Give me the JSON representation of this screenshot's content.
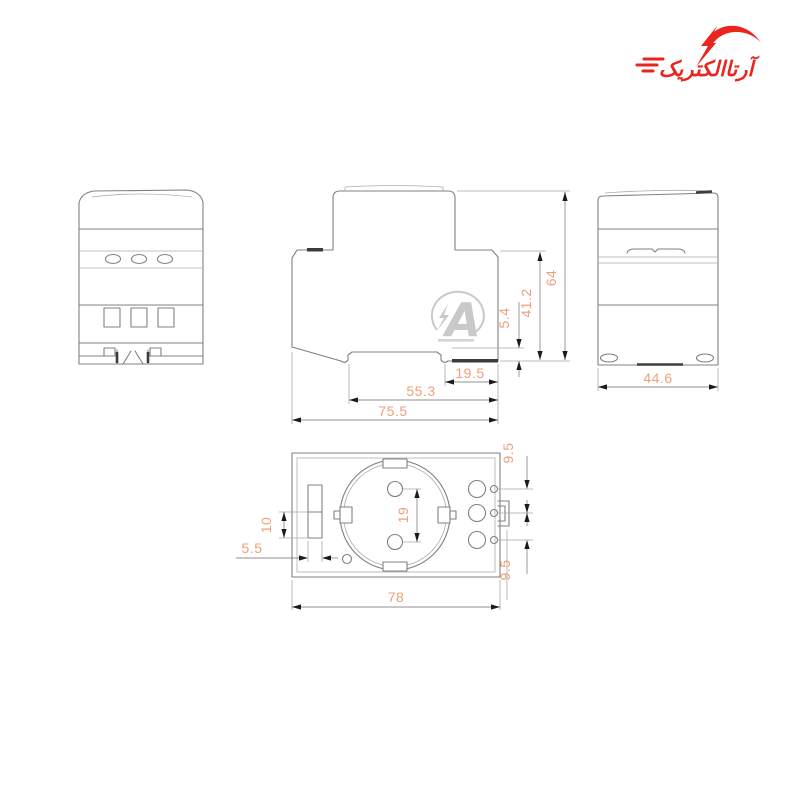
{
  "logo": {
    "text": "آرتاالکتریک",
    "color": "#e8251f"
  },
  "watermark": {
    "letter": "A"
  },
  "dimensions": {
    "side": {
      "total_height": "64",
      "body_height": "41.2",
      "rail_notch": "5.4",
      "rail_width": "19.5",
      "body_depth": "55.3",
      "total_depth": "75.5"
    },
    "back": {
      "width": "44.6"
    },
    "bottom": {
      "width": "78",
      "pin_spacing": "19",
      "slot_height": "10",
      "slot_width": "5.5",
      "terminal_pitch_top": "9.5",
      "terminal_pitch_bottom": "9.5"
    }
  },
  "colors": {
    "dimension_text": "#efa07a",
    "outline": "#808080",
    "arrow": "#1b1b1b",
    "logo_red": "#e8251f",
    "watermark_gray": "#c9c9c9",
    "background": "#ffffff"
  }
}
